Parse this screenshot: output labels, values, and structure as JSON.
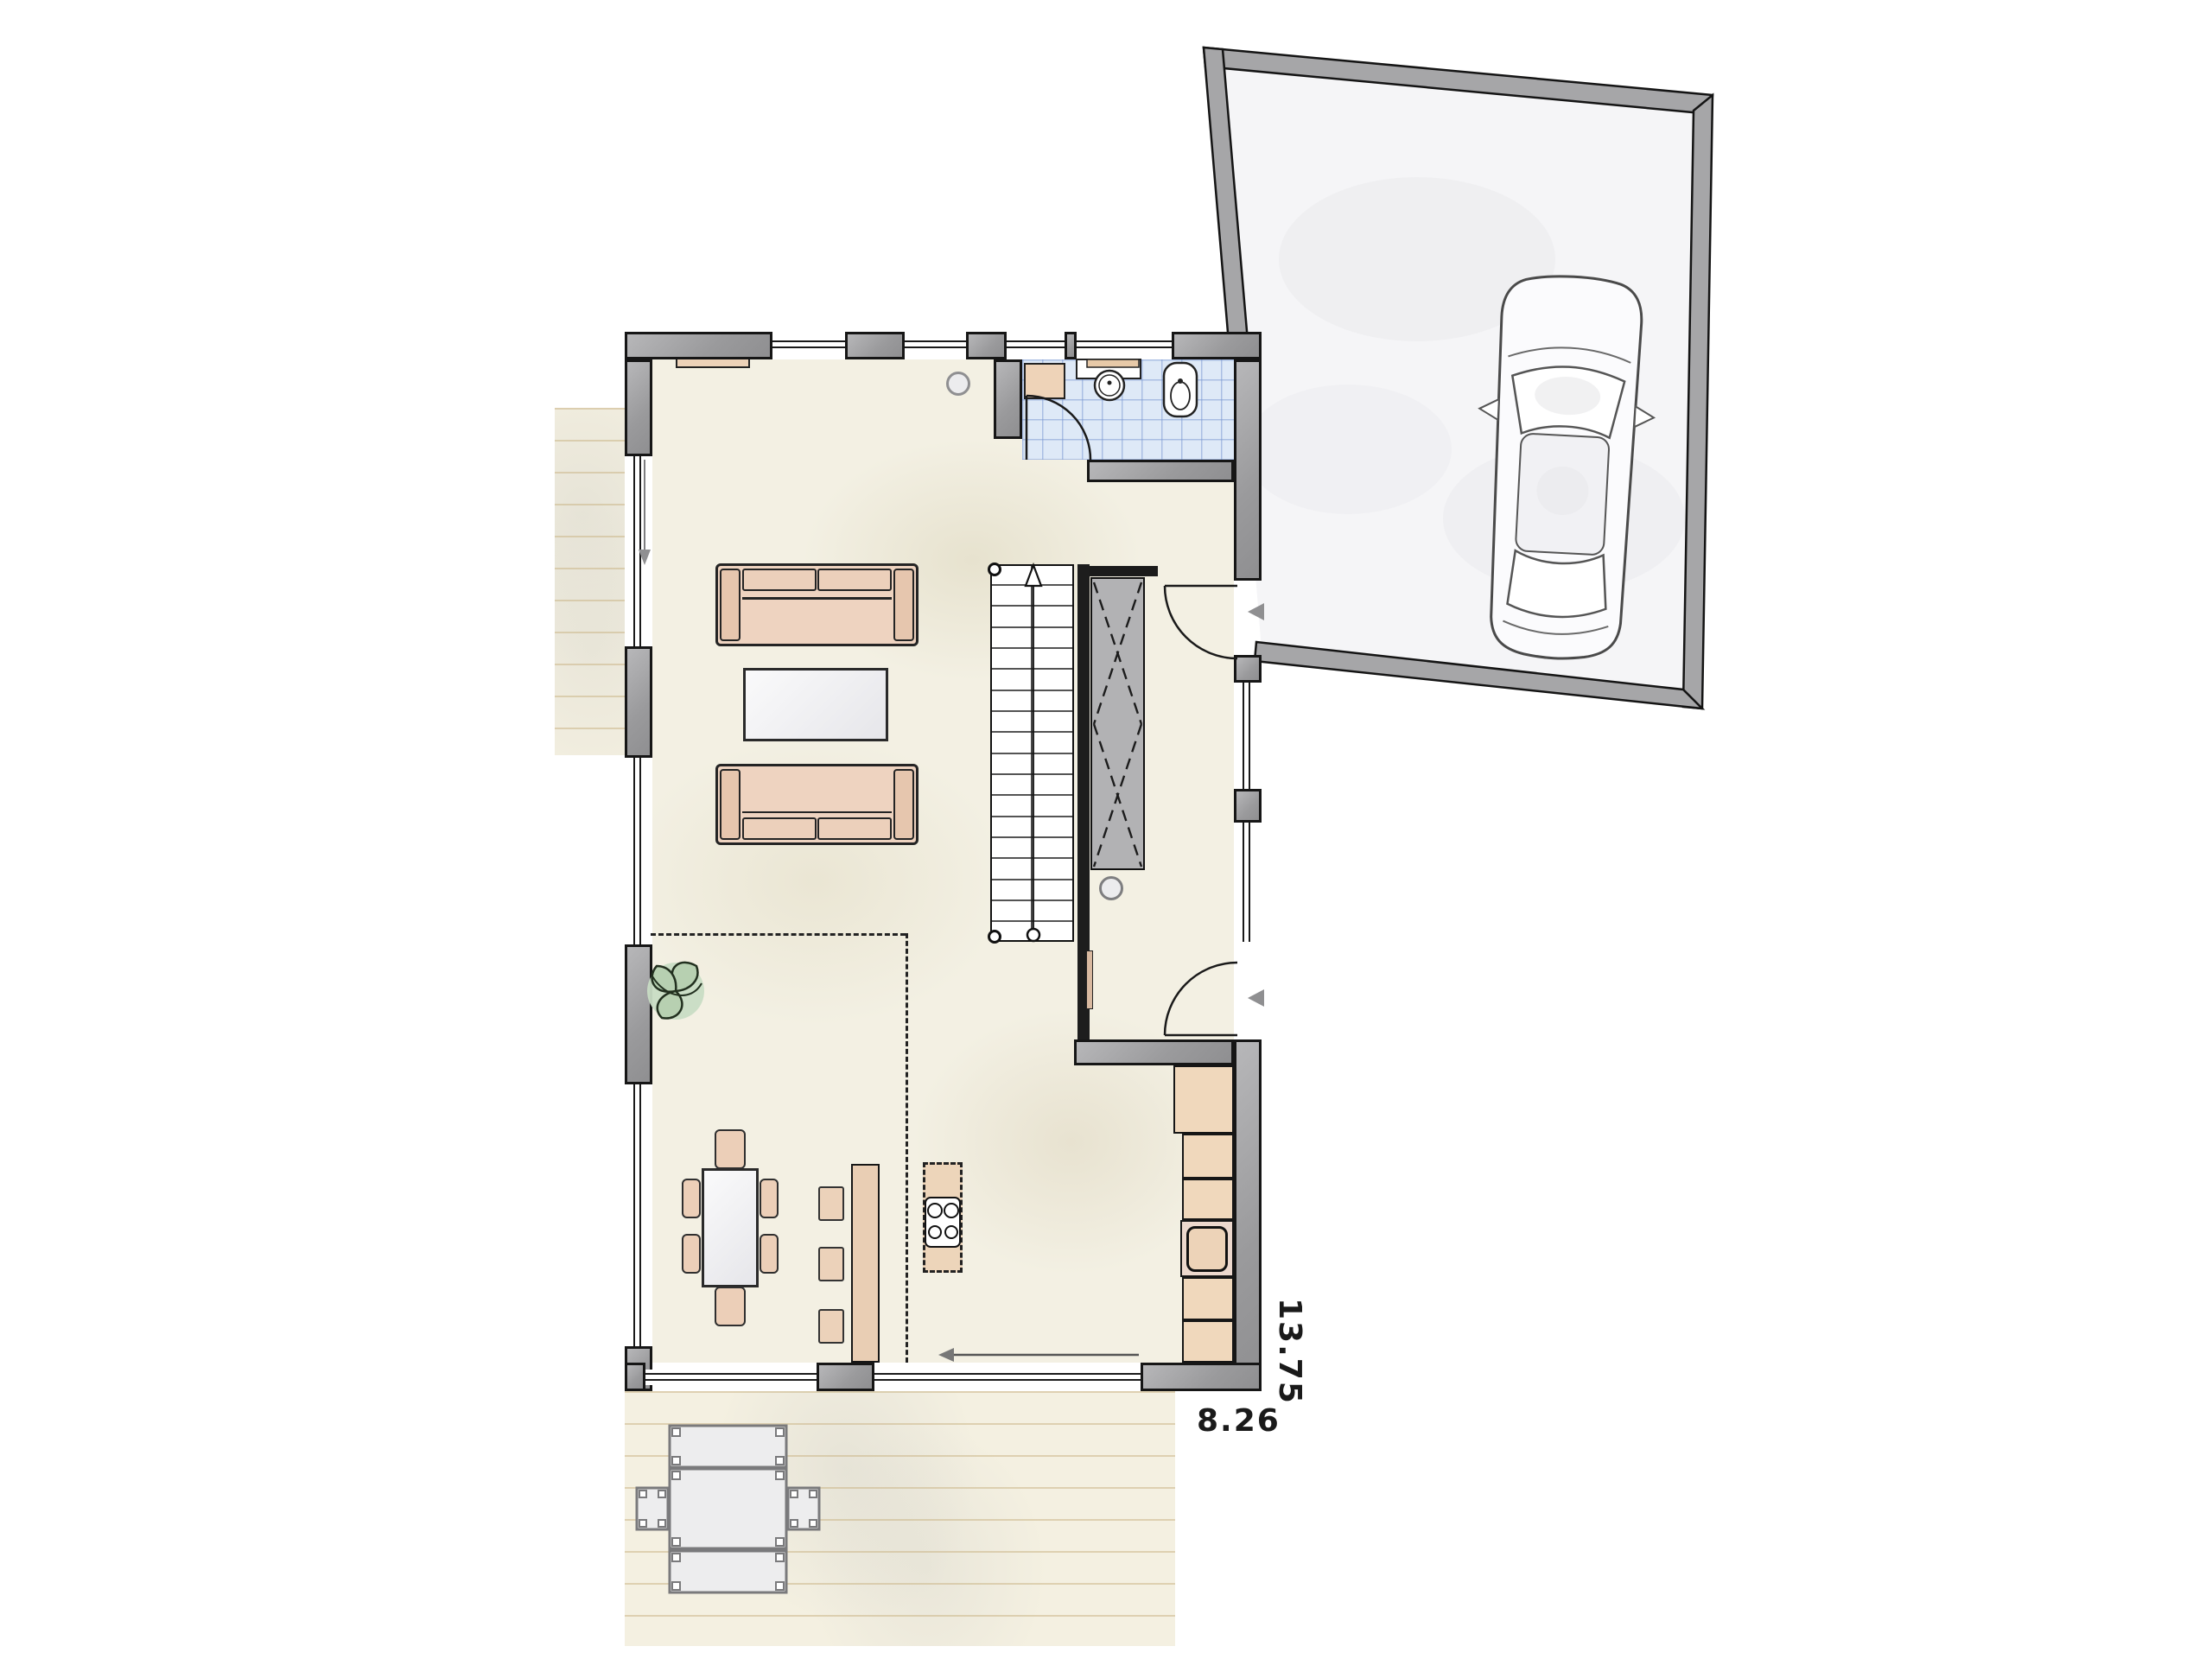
{
  "plan": {
    "title": "ground-floor-plan-with-garage",
    "dimension_labels": {
      "width": "8.26",
      "height": "13.75"
    },
    "colors": {
      "wall_fill": "#9a9a9c",
      "outline": "#161616",
      "floor": "#f3f0e3",
      "bathroom_tile": "#dee9f7",
      "furniture_wood": "#eed3be",
      "terrace": "#f4f0e1",
      "garage_floor": "#f5f5f7",
      "plant_green": "#c8dcc4"
    },
    "rooms": [
      {
        "name": "living-room"
      },
      {
        "name": "dining-area"
      },
      {
        "name": "kitchen"
      },
      {
        "name": "wc-bathroom"
      },
      {
        "name": "hallway"
      },
      {
        "name": "staircase"
      },
      {
        "name": "garage"
      },
      {
        "name": "side-terrace"
      },
      {
        "name": "rear-terrace"
      }
    ],
    "furniture": [
      "sofa",
      "coffee-table",
      "sideboard",
      "dining-table",
      "chairs",
      "bar-counter",
      "bar-stools",
      "kitchen-island",
      "cooktop",
      "sink",
      "refrigerator",
      "wardrobe-closet",
      "washbasin",
      "toilet",
      "plant",
      "car",
      "outdoor-table",
      "outdoor-benches"
    ]
  }
}
